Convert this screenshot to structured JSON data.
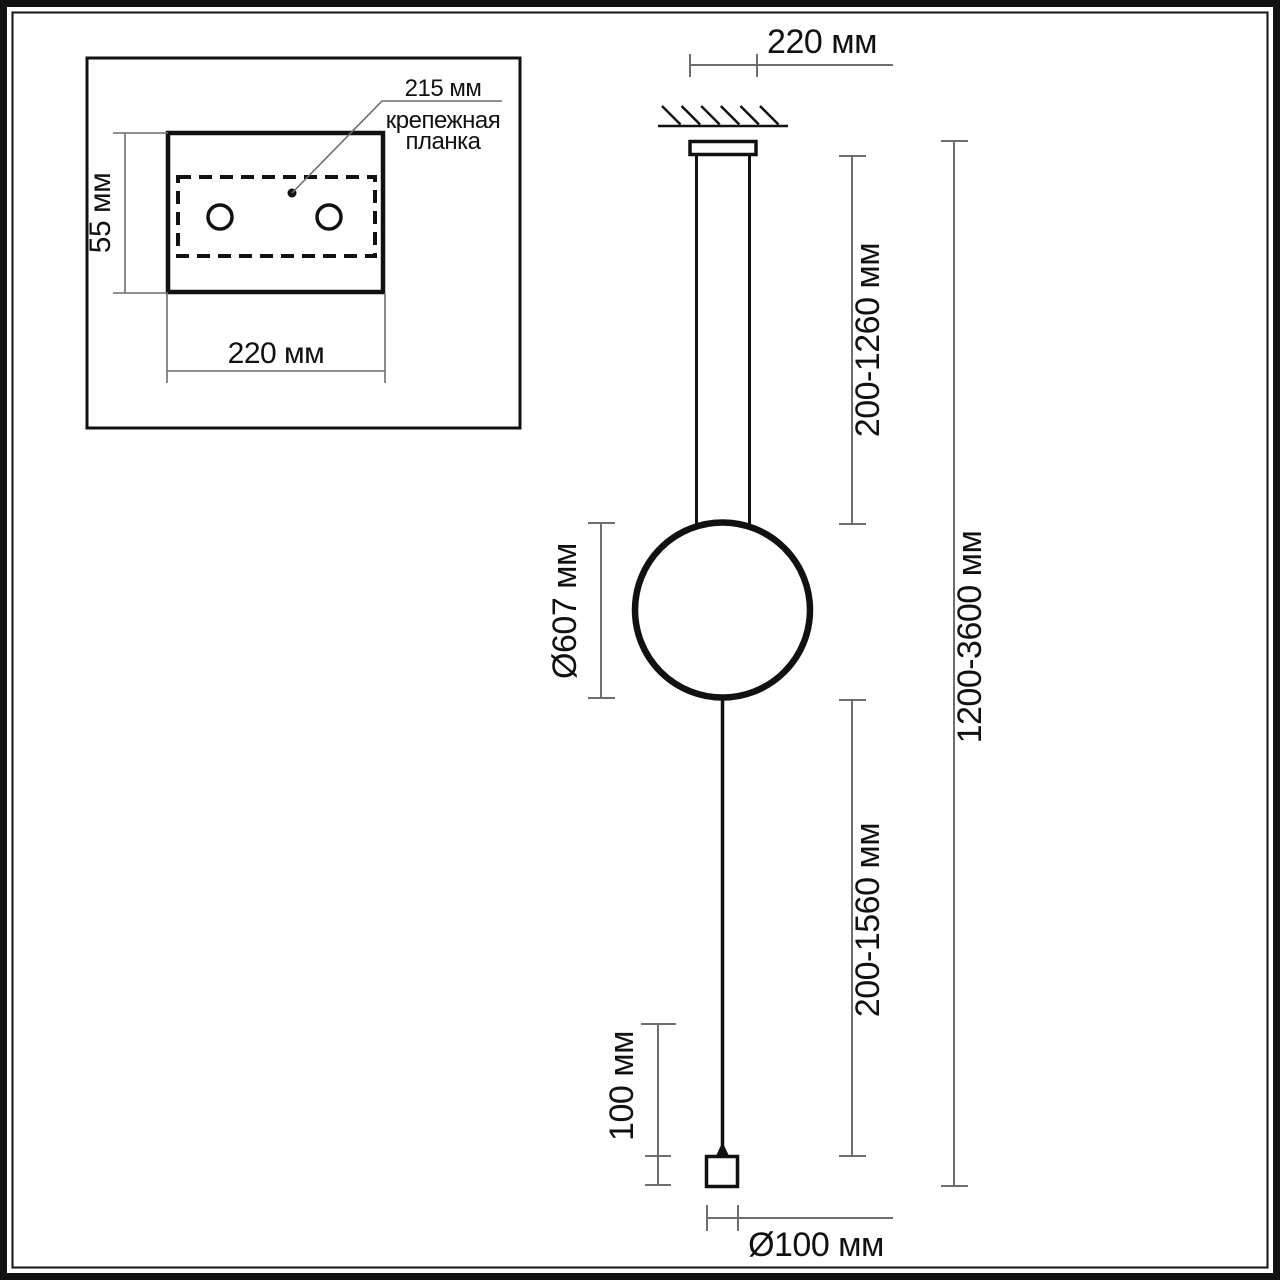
{
  "inset": {
    "bar_length_label": "215 мм",
    "bar_name_line1": "крепежная",
    "bar_name_line2": "планка",
    "plate_height_label": "55 мм",
    "plate_width_label": "220 мм"
  },
  "main": {
    "canopy_width_label": "220 мм",
    "rod_length_label": "200-1260 мм",
    "ring_diameter_label": "Ø607 мм",
    "cable_length_label": "200-1560 мм",
    "total_height_label": "1200-3600 мм",
    "weight_height_label": "100 мм",
    "weight_diameter_label": "Ø100 мм"
  },
  "colors": {
    "object_line": "#111111",
    "dimension_line": "#6e6e6e",
    "text": "#111111",
    "background": "#ffffff"
  }
}
